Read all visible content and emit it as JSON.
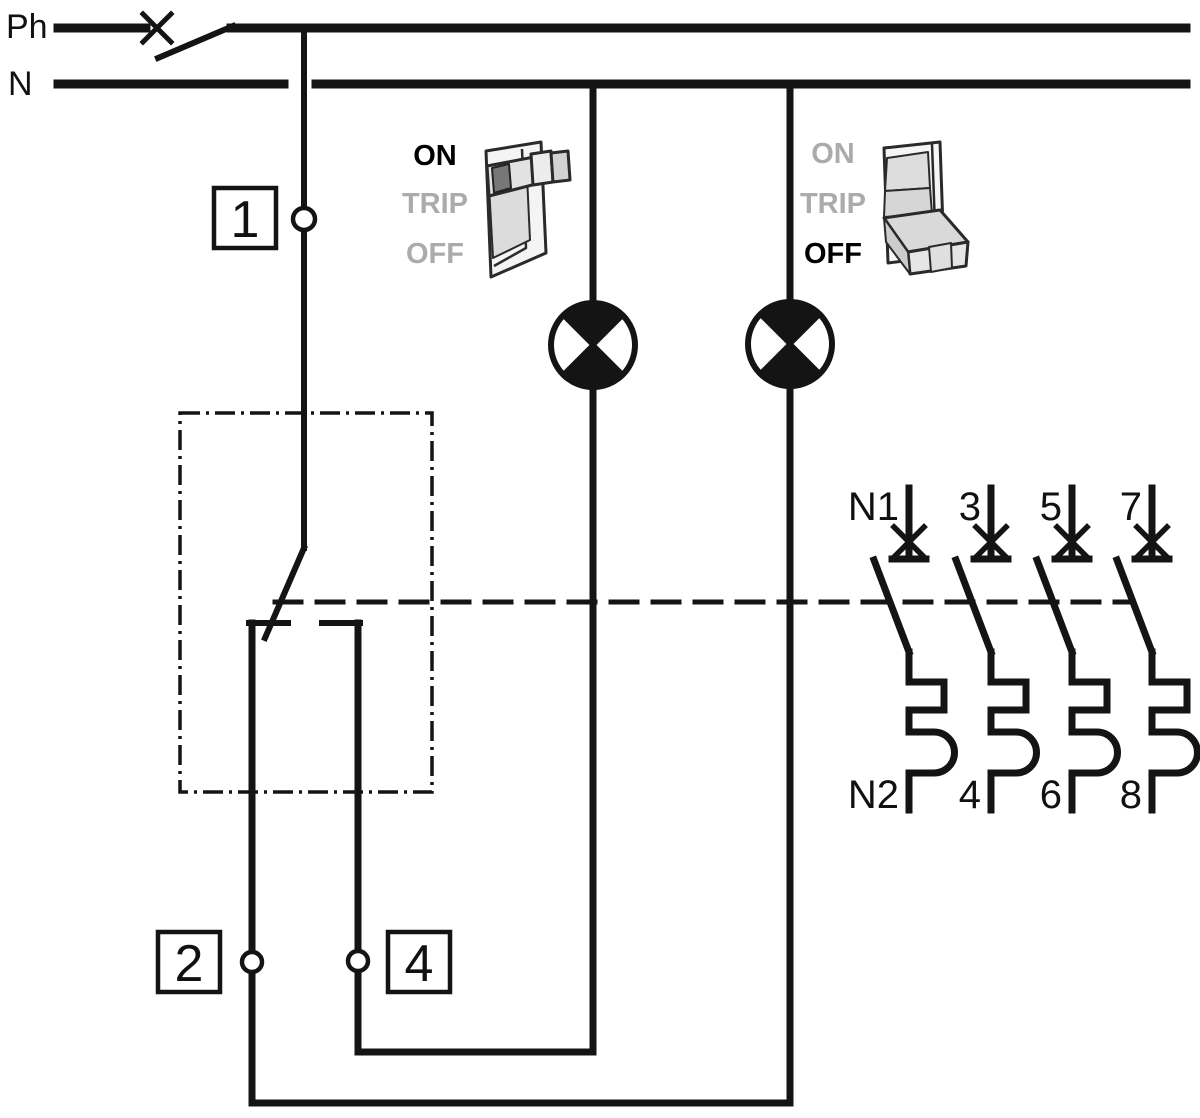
{
  "supply": {
    "phase_label": "Ph",
    "neutral_label": "N"
  },
  "terminals": {
    "input": "1",
    "output_left": "2",
    "output_right": "4"
  },
  "switch_left": {
    "on": "ON",
    "trip": "TRIP",
    "off": "OFF",
    "active_state": "ON"
  },
  "switch_right": {
    "on": "ON",
    "trip": "TRIP",
    "off": "OFF",
    "active_state": "OFF"
  },
  "breaker": {
    "top_terminals": [
      "N1",
      "3",
      "5",
      "7"
    ],
    "bottom_terminals": [
      "N2",
      "4",
      "6",
      "8"
    ]
  },
  "colors": {
    "line": "#141414",
    "active_label": "#000000",
    "inactive_label": "#ababab",
    "icon_fill_light": "#f4f4f4",
    "icon_fill_mid": "#d9d9d9"
  }
}
